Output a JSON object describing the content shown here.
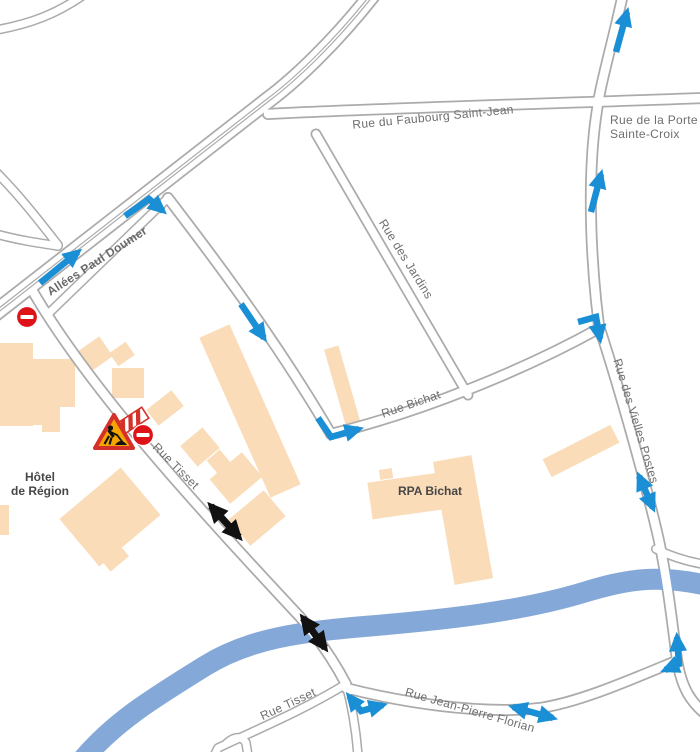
{
  "map": {
    "description": "City street map with roadworks, closures and one-way traffic arrows",
    "streets": {
      "allees_paul_doumer": "Allées Paul Doumer",
      "rue_du_faubourg_saint_jean": "Rue du Faubourg Saint-Jean",
      "rue_de_la_porte_line1": "Rue de la Porte",
      "rue_de_la_porte_line2": "Sainte-Croix",
      "rue_des_jardins": "Rue des Jardins",
      "rue_bichat": "Rue Bichat",
      "rue_des_vielles_postes": "Rue des Vielles Postes",
      "rue_tisset": "Rue Tisset",
      "rue_tisset_south": "Rue Tisset",
      "rue_jean_pierre_florian": "Rue Jean-Pierre Florian"
    },
    "places": {
      "hotel_de_region_line1": "Hôtel",
      "hotel_de_region_line2": "de Région",
      "rpa_bichat": "RPA Bichat"
    },
    "markers": {
      "blue_one_way_arrows": [
        {
          "icon": "arrow-straight",
          "street": "Allées Paul Doumer",
          "direction": "northeast"
        },
        {
          "icon": "arrow-turn",
          "street": "Allées Paul Doumer into side street",
          "direction": "turn southeast"
        },
        {
          "icon": "arrow-straight",
          "street": "side street toward Rue Bichat",
          "direction": "southeast"
        },
        {
          "icon": "arrow-turn",
          "street": "corner onto Rue Bichat",
          "direction": "turn east"
        },
        {
          "icon": "arrow-straight",
          "street": "Rue de la Porte Sainte-Croix top",
          "direction": "north"
        },
        {
          "icon": "arrow-straight",
          "street": "Rue de la Porte Sainte-Croix middle",
          "direction": "north"
        },
        {
          "icon": "arrow-turn",
          "street": "Rue Bichat onto Rue des Vielles Postes",
          "direction": "turn south"
        },
        {
          "icon": "arrow-double",
          "street": "Rue des Vielles Postes",
          "direction": "two-way"
        },
        {
          "icon": "arrow-double-turn",
          "street": "Rue Tisset / Rue Jean-Pierre Florian junction",
          "direction": "two-way turn"
        },
        {
          "icon": "arrow-double",
          "street": "Rue Jean-Pierre Florian",
          "direction": "two-way"
        },
        {
          "icon": "arrow-double-turn",
          "street": "Rue Jean-Pierre Florian / Rue des Vielles Postes junction",
          "direction": "two-way turn"
        }
      ],
      "black_two_way_arrows": [
        {
          "icon": "arrow-double",
          "street": "Rue Tisset north of river"
        },
        {
          "icon": "arrow-double",
          "street": "Rue Tisset at river crossing"
        }
      ],
      "signs": [
        {
          "icon": "no-entry-sign",
          "location": "Rue Tisset at Allées Paul Doumer"
        },
        {
          "icon": "roadworks-sign",
          "location": "Rue Tisset"
        },
        {
          "icon": "barrier-closed-sign",
          "location": "Rue Tisset"
        },
        {
          "icon": "no-entry-sign",
          "location": "Rue Tisset"
        }
      ]
    },
    "colors": {
      "road_casing": "#ABABAB",
      "road_fill": "#FFFFFF",
      "building": "#FADCB9",
      "river": "#84A9D8",
      "arrow_blue": "#1A8FD6",
      "arrow_black": "#111111",
      "sign_red": "#DE1317",
      "roadworks_orange": "#F5A400",
      "label_gray": "#6E6E6E",
      "label_dark": "#474747"
    }
  }
}
